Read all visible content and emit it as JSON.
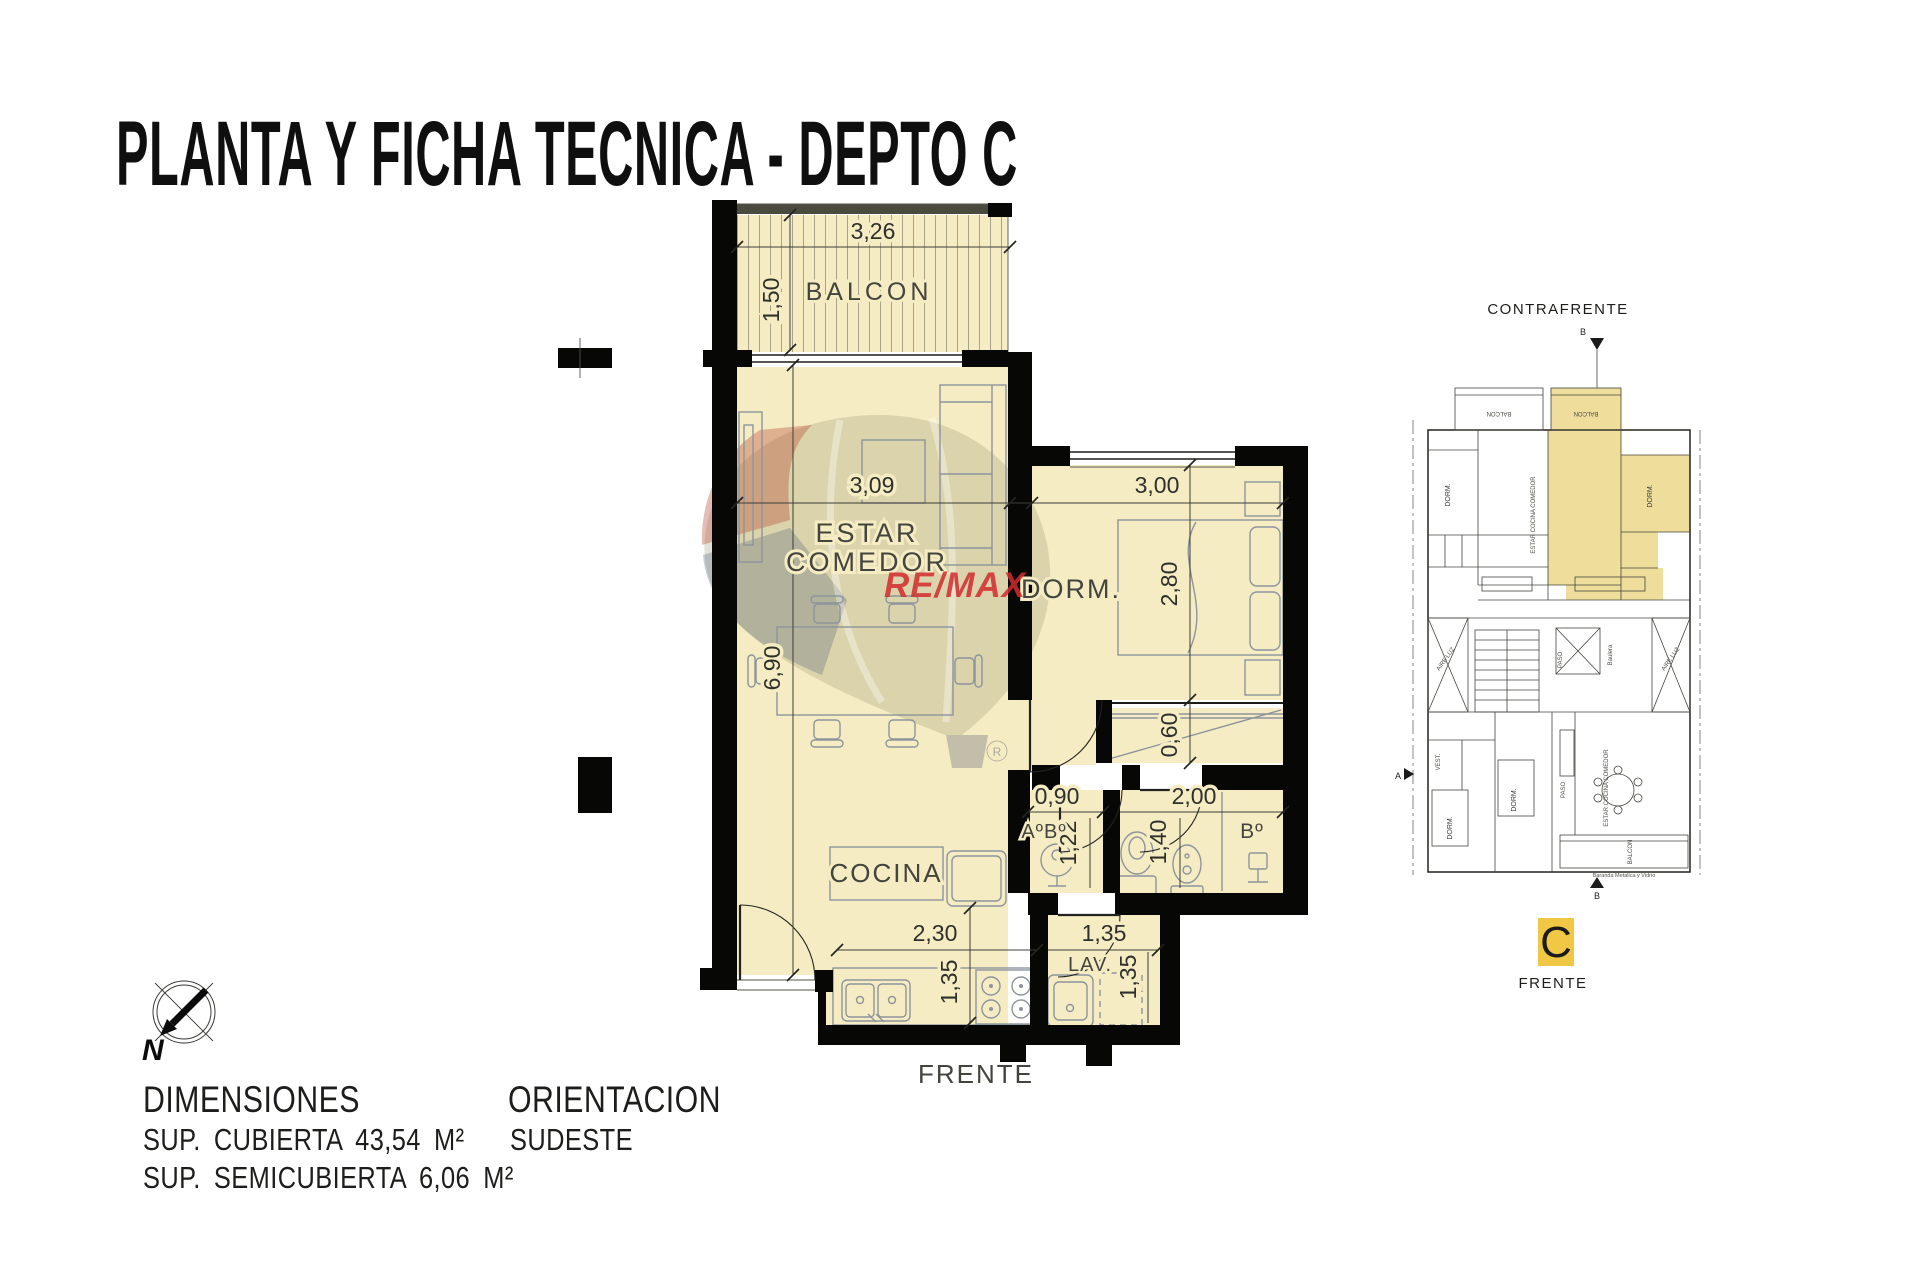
{
  "title": "PLANTA Y FICHA TECNICA - DEPTO C",
  "watermark": {
    "brand": "RE/MAX",
    "registered": "R"
  },
  "main_plan": {
    "front_label": "FRENTE",
    "balcony": {
      "name": "BALCON",
      "width": "3,26",
      "depth": "1,50"
    },
    "living": {
      "name_line1": "ESTAR",
      "name_line2": "COMEDOR",
      "width": "3,09",
      "length": "6,90"
    },
    "bedroom": {
      "name": "DORM.",
      "width": "3,00",
      "depth": "2,80"
    },
    "closet": {
      "depth": "0,60"
    },
    "toilette": {
      "name": "AºBº",
      "width": "0,90",
      "depth": "1,22"
    },
    "bathroom": {
      "name": "Bº",
      "width": "2,00",
      "depth": "1,40"
    },
    "kitchen": {
      "name": "COCINA",
      "width": "2,30",
      "depth": "1,35"
    },
    "laundry": {
      "name": "LAV.",
      "width": "1,35",
      "depth": "1,35"
    }
  },
  "site_plan": {
    "top_label": "CONTRAFRENTE",
    "bottom_label": "FRENTE",
    "unit_badge": "C",
    "section_marker": "B",
    "side_marker": "A",
    "labels": {
      "dorm": "DORM.",
      "estar_cocina_comedor": "ESTAR COCINA COMEDOR",
      "balcon": "BALCON",
      "paso": "PASO",
      "aire_luz": "AIRE LUZ",
      "vest": "VEST.",
      "baulera": "Baulera",
      "baranda": "Baranda Metalica y Vidrio"
    }
  },
  "info": {
    "dimensions_title": "DIMENSIONES",
    "sup_cubierta": "SUP. CUBIERTA 43,54 M²",
    "sup_semicubierta": "SUP. SEMICUBIERTA 6,06 M²",
    "orientation_title": "ORIENTACION",
    "orientation_value": "SUDESTE",
    "compass_north": "N"
  },
  "colors": {
    "room_fill": "#f5ecc3",
    "wall": "#070705",
    "fixture_line": "#8d949c",
    "highlight_yellow": "#eedd9b",
    "badge_yellow": "#f1c846",
    "remax_red": "#d22b2e"
  }
}
